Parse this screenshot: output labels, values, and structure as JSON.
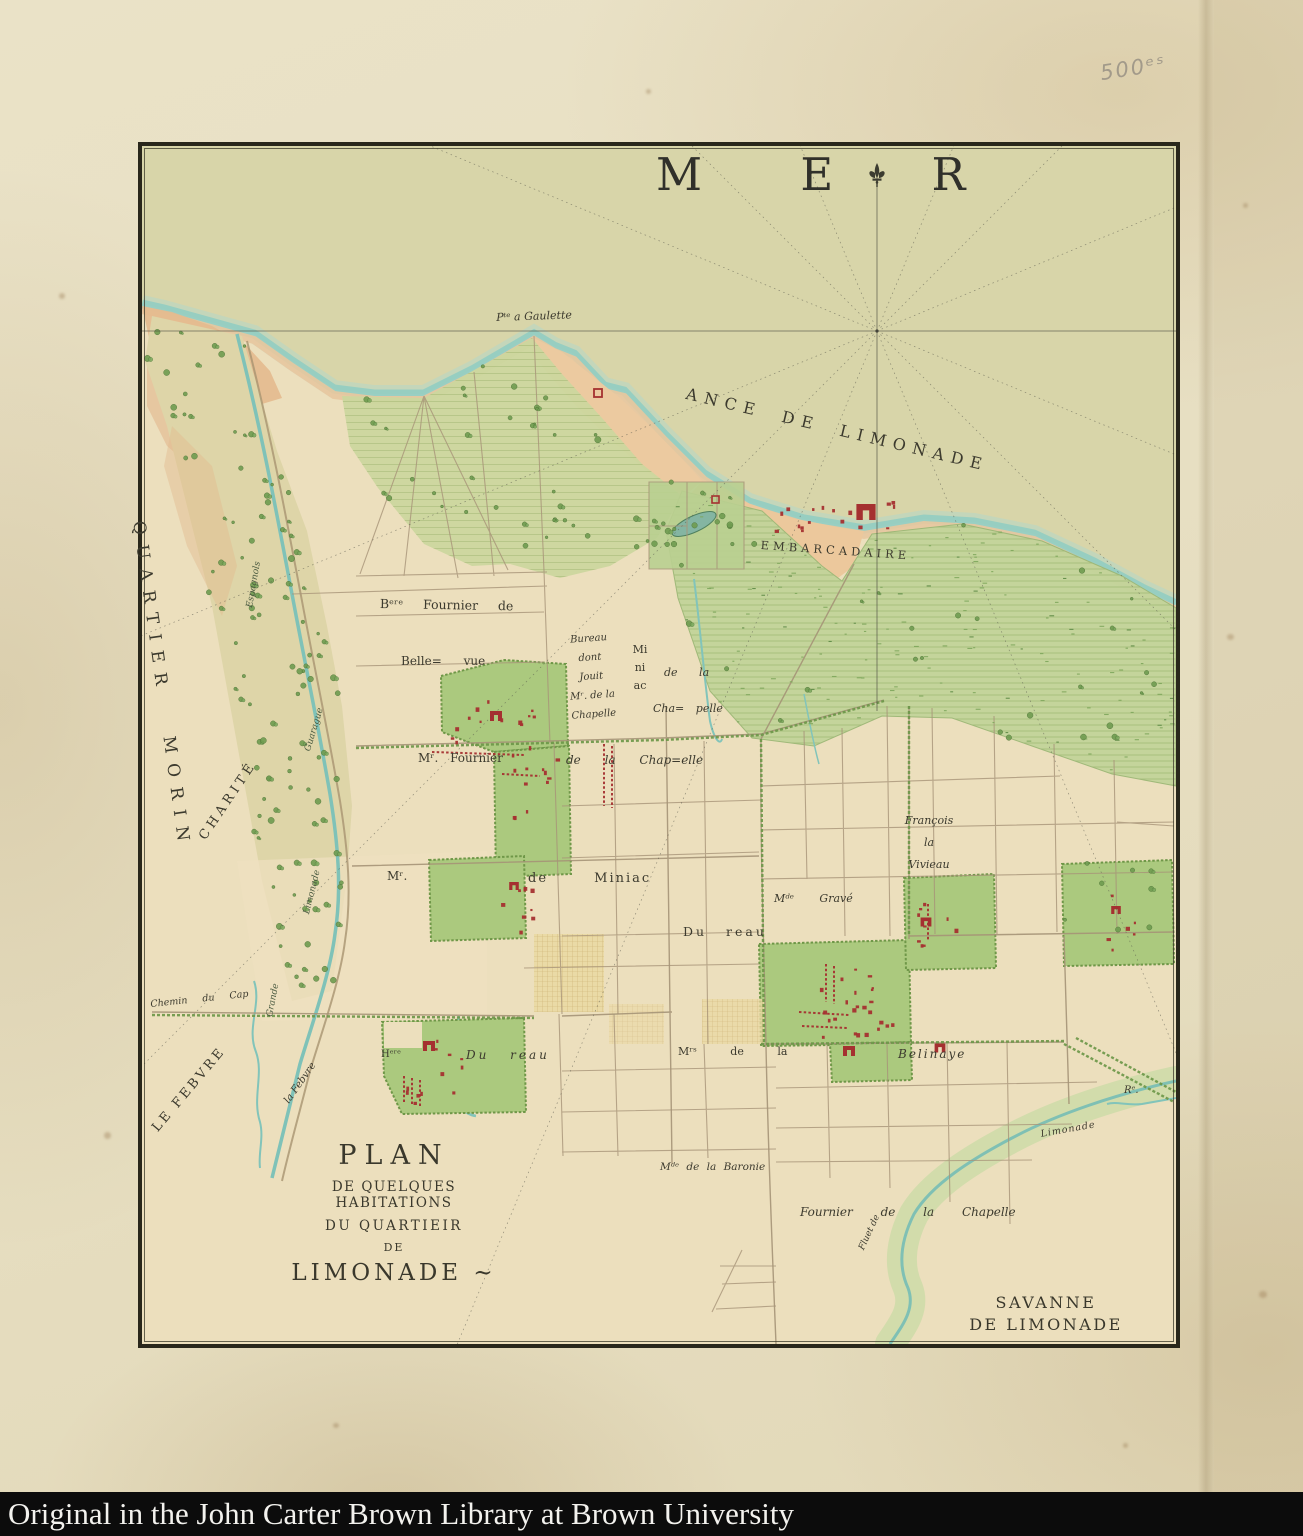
{
  "page": {
    "caption": "Original in the John Carter Brown Library at Brown University",
    "pencil_note": "500ᵉˢ"
  },
  "map": {
    "sea_label": "M E R",
    "coast": {
      "pte_a_gaulette": "Pᵗᵉ a Gaulette",
      "ance_de_limonade": "ANCE DE LIMONADE",
      "embarcadaire": "EMBARCADAIRE"
    },
    "regions": {
      "quartier_morin": "QUARTIER MORIN",
      "charite": "CHARITÉ",
      "le_febvre": "LE FEBVRE",
      "savanne_line1": "SAVANNE",
      "savanne_line2": "DE LIMONADE"
    },
    "rivers": {
      "espagnols": "Espagnols",
      "guarague": "Guarague",
      "limonade_upper": "Limonade",
      "grande": "Grande",
      "la_febvre": "la Febvre",
      "chemin_du_cap": "Chemin du Cap",
      "re": "Rᵉ.",
      "limonade_lower": "Limonade",
      "fluet": "Fluet de"
    },
    "estates": {
      "bere_fournier_de": "Bᵉʳᵉ Fournier de",
      "belle_vue": "Belle= vue",
      "bureau_dont": [
        "Bureau",
        "dont",
        "Jouit",
        "Mʳ. de la",
        "Chapelle"
      ],
      "miniac_vertical": [
        "Mi",
        "ni",
        "ac"
      ],
      "de_la": "de la",
      "cha_pelle": "Cha= pelle",
      "mr_fournier": "Mʳ. Fournier",
      "de_la_chapelle": "de la Chap=elle",
      "mr": "Mʳ.",
      "de_miniac": "de Miniac",
      "francois_la_vivieau": [
        "François",
        "la",
        "Vivieau"
      ],
      "mde_grave": "Mᵈᵉ Gravé",
      "dureau_east": "Du reau",
      "heritiers": "Hᵉʳᵉ",
      "dureau_west": "Du reau",
      "mrs_de_la": "Mʳˢ de la",
      "belinaye": "Belinaye",
      "mde_de_la_baronie": "Mᵈᵉ de la Baronie",
      "fournier_de_la_chapelle": "Fournier de la Chapelle"
    },
    "title_block": [
      "PLAN",
      "DE QUELQUES HABITATIONS",
      "DU QUARTIEIR",
      "DE",
      "LIMONADE ~"
    ]
  },
  "colors": {
    "paper": "#e7dfc2",
    "sea": "#d8d5a9",
    "shore_teal": "#8fccc2",
    "beach_sand": "#ecc89c",
    "land": "#ecdfbd",
    "plantation_green": "#abc97e",
    "savanna_green": "#c3d49a",
    "hedge_green": "#6d9749",
    "building_red": "#a53030",
    "frame_black": "#29271b",
    "caption_bg": "#0c0c0c",
    "caption_text": "#f3f2ee"
  }
}
